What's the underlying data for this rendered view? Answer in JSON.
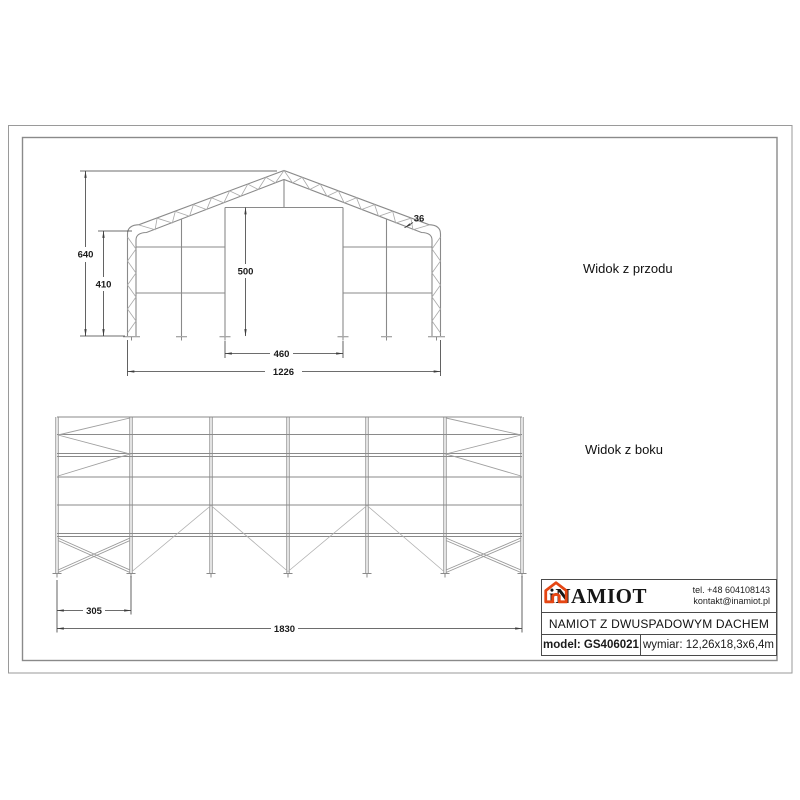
{
  "front_view": {
    "label": "Widok z przodu",
    "dimensions": {
      "total_height": "640",
      "eave_height": "410",
      "door_height": "500",
      "door_width": "460",
      "total_width": "1226",
      "truss_depth": "36"
    }
  },
  "side_view": {
    "label": "Widok z boku",
    "dimensions": {
      "end_bay_width": "305",
      "total_length": "1830"
    }
  },
  "title_block": {
    "brand": "iNAMIOT",
    "phone": "tel. +48 604108143",
    "email": "kontakt@inamiot.pl",
    "product_name": "NAMIOT Z DWUSPADOWYM DACHEM",
    "model": "model: GS406021",
    "dimensions": "wymiar: 12,26x18,3x6,4m",
    "accent_color": "#e54613"
  }
}
